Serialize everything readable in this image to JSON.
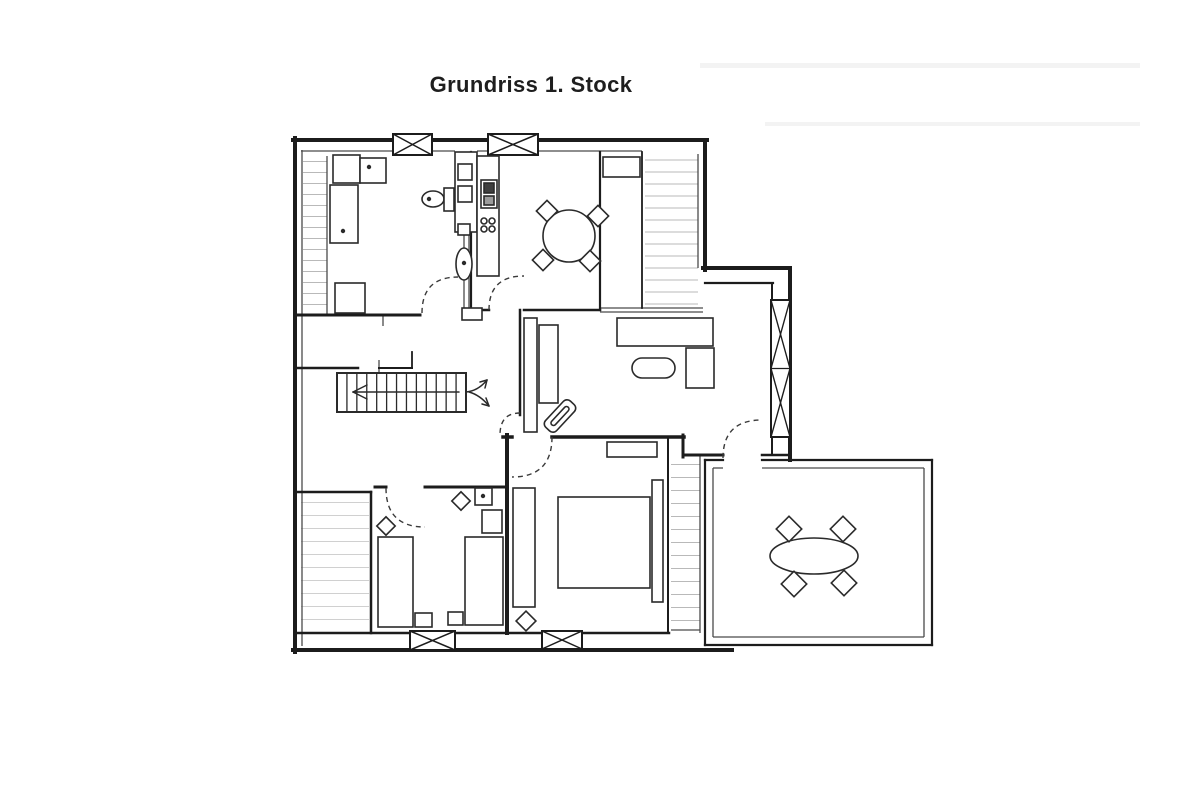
{
  "title": "Grundriss 1. Stock",
  "colors": {
    "ink": "#2a2a2a",
    "wall": "#1c1c1c",
    "thin": "#4a4a4a",
    "label": "#363636",
    "door": "#3a3a3a",
    "paper": "#ffffff",
    "hatch": "#b9b9b9",
    "hatch_light": "#d0d0d0",
    "streak": "#f3f3f3"
  },
  "rooms": [
    {
      "id": "bad",
      "label": "Bad",
      "cx": 400,
      "cy": 251,
      "size": 10
    },
    {
      "id": "kueche",
      "label": "Küche mit Essplatz",
      "cx": 562,
      "cy": 287,
      "size": 11
    },
    {
      "id": "wohnzimmer",
      "label": "Wohnzimmer",
      "cx": 647,
      "cy": 412,
      "size": 11
    },
    {
      "id": "flur",
      "label": "Flur",
      "cx": 422,
      "cy": 447,
      "size": 11.5
    },
    {
      "id": "schlafzimmer1",
      "label": "Schlafzimmer 1",
      "cx": 601,
      "cy": 480,
      "size": 11
    },
    {
      "id": "schlafzimmer2",
      "label": "Schlafzimmer 2",
      "cx": 436,
      "cy": 530,
      "size": 11
    },
    {
      "id": "dachterrasse",
      "label": "Dachterrasse",
      "cx": 804,
      "cy": 501,
      "size": 12.5
    }
  ],
  "streaks": [
    {
      "x": 700,
      "y": 63,
      "w": 440,
      "h": 5
    },
    {
      "x": 765,
      "y": 122,
      "w": 375,
      "h": 4
    }
  ],
  "walls": [
    {
      "x1": 293,
      "y1": 140,
      "x2": 707,
      "y2": 140,
      "w": 4
    },
    {
      "x1": 705,
      "y1": 140,
      "x2": 705,
      "y2": 270,
      "w": 4
    },
    {
      "x1": 703,
      "y1": 268,
      "x2": 790,
      "y2": 268,
      "w": 4
    },
    {
      "x1": 790,
      "y1": 268,
      "x2": 790,
      "y2": 460,
      "w": 4
    },
    {
      "x1": 295,
      "y1": 138,
      "x2": 295,
      "y2": 652,
      "w": 4
    },
    {
      "x1": 293,
      "y1": 650,
      "x2": 732,
      "y2": 650,
      "w": 4
    },
    {
      "x1": 705,
      "y1": 283,
      "x2": 773,
      "y2": 283,
      "w": 2.2
    },
    {
      "x1": 772,
      "y1": 283,
      "x2": 772,
      "y2": 455,
      "w": 2
    },
    {
      "x1": 683,
      "y1": 435,
      "x2": 683,
      "y2": 457,
      "w": 3
    },
    {
      "x1": 683,
      "y1": 455,
      "x2": 723,
      "y2": 455,
      "w": 3
    },
    {
      "x1": 762,
      "y1": 455,
      "x2": 790,
      "y2": 455,
      "w": 2.5
    },
    {
      "x1": 295,
      "y1": 315,
      "x2": 420,
      "y2": 315,
      "w": 3
    },
    {
      "x1": 471,
      "y1": 152,
      "x2": 471,
      "y2": 318,
      "w": 2.2
    },
    {
      "x1": 295,
      "y1": 368,
      "x2": 358,
      "y2": 368,
      "w": 2.5
    },
    {
      "x1": 379,
      "y1": 368,
      "x2": 412,
      "y2": 368,
      "w": 2
    },
    {
      "x1": 412,
      "y1": 352,
      "x2": 412,
      "y2": 368,
      "w": 1.8
    },
    {
      "x1": 471,
      "y1": 310,
      "x2": 489,
      "y2": 310,
      "w": 2.5
    },
    {
      "x1": 524,
      "y1": 310,
      "x2": 600,
      "y2": 310,
      "w": 2.5
    },
    {
      "x1": 642,
      "y1": 152,
      "x2": 642,
      "y2": 308,
      "w": 1.8
    },
    {
      "x1": 600,
      "y1": 152,
      "x2": 600,
      "y2": 310,
      "w": 2.2
    },
    {
      "x1": 520,
      "y1": 310,
      "x2": 520,
      "y2": 415,
      "w": 2.5
    },
    {
      "x1": 503,
      "y1": 437,
      "x2": 512,
      "y2": 437,
      "w": 3.5
    },
    {
      "x1": 552,
      "y1": 437,
      "x2": 684,
      "y2": 437,
      "w": 3.5
    },
    {
      "x1": 507,
      "y1": 435,
      "x2": 507,
      "y2": 633,
      "w": 4
    },
    {
      "x1": 375,
      "y1": 487,
      "x2": 386,
      "y2": 487,
      "w": 3
    },
    {
      "x1": 425,
      "y1": 487,
      "x2": 504,
      "y2": 487,
      "w": 3
    },
    {
      "x1": 295,
      "y1": 492,
      "x2": 371,
      "y2": 492,
      "w": 2.5
    },
    {
      "x1": 371,
      "y1": 492,
      "x2": 371,
      "y2": 633,
      "w": 2.5
    },
    {
      "x1": 295,
      "y1": 633,
      "x2": 410,
      "y2": 633,
      "w": 2.5
    },
    {
      "x1": 455,
      "y1": 633,
      "x2": 542,
      "y2": 633,
      "w": 2.5
    },
    {
      "x1": 583,
      "y1": 633,
      "x2": 669,
      "y2": 633,
      "w": 2.5
    },
    {
      "x1": 668,
      "y1": 437,
      "x2": 668,
      "y2": 633,
      "w": 2
    },
    {
      "x1": 705,
      "y1": 460,
      "x2": 723,
      "y2": 460,
      "w": 2.2
    },
    {
      "x1": 762,
      "y1": 460,
      "x2": 932,
      "y2": 460,
      "w": 2.2
    },
    {
      "x1": 932,
      "y1": 460,
      "x2": 932,
      "y2": 645,
      "w": 2.2
    },
    {
      "x1": 705,
      "y1": 645,
      "x2": 932,
      "y2": 645,
      "w": 2.2
    },
    {
      "x1": 705,
      "y1": 460,
      "x2": 705,
      "y2": 645,
      "w": 2.2
    }
  ],
  "thin_lines": [
    {
      "x1": 301,
      "y1": 151,
      "x2": 455,
      "y2": 151
    },
    {
      "x1": 477,
      "y1": 151,
      "x2": 642,
      "y2": 151
    },
    {
      "x1": 302,
      "y1": 150,
      "x2": 302,
      "y2": 646
    },
    {
      "x1": 327,
      "y1": 156,
      "x2": 327,
      "y2": 314
    },
    {
      "x1": 698,
      "y1": 154,
      "x2": 698,
      "y2": 268
    },
    {
      "x1": 700,
      "y1": 455,
      "x2": 700,
      "y2": 633
    },
    {
      "x1": 600,
      "y1": 308,
      "x2": 703,
      "y2": 308
    },
    {
      "x1": 600,
      "y1": 312,
      "x2": 703,
      "y2": 312
    },
    {
      "x1": 464,
      "y1": 232,
      "x2": 464,
      "y2": 308
    },
    {
      "x1": 469,
      "y1": 232,
      "x2": 469,
      "y2": 308
    },
    {
      "x1": 379,
      "y1": 360,
      "x2": 379,
      "y2": 373
    },
    {
      "x1": 383,
      "y1": 315,
      "x2": 383,
      "y2": 326
    },
    {
      "x1": 713,
      "y1": 468,
      "x2": 713,
      "y2": 637
    },
    {
      "x1": 924,
      "y1": 468,
      "x2": 924,
      "y2": 637
    },
    {
      "x1": 713,
      "y1": 637,
      "x2": 924,
      "y2": 637
    },
    {
      "x1": 713,
      "y1": 468,
      "x2": 723,
      "y2": 468
    },
    {
      "x1": 762,
      "y1": 468,
      "x2": 924,
      "y2": 468
    },
    {
      "x1": 671,
      "y1": 630,
      "x2": 700,
      "y2": 630
    }
  ],
  "hatch_areas": [
    {
      "x": 303,
      "y": 156,
      "w": 24,
      "h": 158,
      "s": 11,
      "c": "#b9b9b9"
    },
    {
      "x": 645,
      "y": 154,
      "w": 53,
      "h": 152,
      "s": 12,
      "c": "#b9b9b9"
    },
    {
      "x": 671,
      "y": 458,
      "w": 29,
      "h": 170,
      "s": 13,
      "c": "#b9b9b9"
    },
    {
      "x": 301,
      "y": 496,
      "w": 68,
      "h": 134,
      "s": 13,
      "c": "#d0d0d0"
    }
  ],
  "windows": [
    {
      "x": 393,
      "y": 134,
      "w": 39,
      "h": 21
    },
    {
      "x": 488,
      "y": 134,
      "w": 50,
      "h": 21
    },
    {
      "x": 410,
      "y": 631,
      "w": 45,
      "h": 19
    },
    {
      "x": 542,
      "y": 631,
      "w": 40,
      "h": 18
    },
    {
      "x": 771,
      "y": 300,
      "w": 19,
      "h": 137
    }
  ],
  "doors": [
    {
      "name": "bad-door",
      "d": "M 422 313 Q 422 277 458 277"
    },
    {
      "name": "kitchen-door",
      "d": "M 489 310 Q 489 276 524 276"
    },
    {
      "name": "bedroom1-door",
      "d": "M 552 437 Q 552 477 512 477"
    },
    {
      "name": "bedroom2-door",
      "d": "M 386 488 Q 386 527 425 527"
    },
    {
      "name": "terrace-door",
      "d": "M 723 458 Q 723 420 762 420"
    },
    {
      "name": "hall-passage-door",
      "d": "M 520 413 Q 500 413 500 435"
    }
  ],
  "stairs": {
    "x": 337,
    "y": 373,
    "w": 129,
    "h": 39,
    "treads": 13
  },
  "arrows": {
    "lines": [
      [
        353,
        392,
        459,
        392
      ],
      [
        353,
        392,
        367,
        385
      ],
      [
        353,
        392,
        367,
        399
      ],
      [
        487,
        380,
        480,
        382
      ],
      [
        487,
        380,
        485,
        388
      ],
      [
        489,
        406,
        482,
        404
      ],
      [
        489,
        406,
        486,
        398
      ]
    ],
    "curves": [
      "M 466 392 Q 478 391 487 380",
      "M 469 392 Q 480 395 489 406"
    ]
  },
  "furniture": [
    {
      "room": "bad",
      "items": [
        {
          "name": "bath-vanity",
          "type": "rect",
          "x": 333,
          "y": 155,
          "w": 27,
          "h": 28
        },
        {
          "name": "bath-vanity-2",
          "type": "rect",
          "x": 360,
          "y": 158,
          "w": 26,
          "h": 25,
          "dot": [
            369,
            167
          ]
        },
        {
          "name": "shower",
          "type": "rect",
          "x": 330,
          "y": 185,
          "w": 28,
          "h": 58,
          "dot": [
            343,
            231
          ]
        },
        {
          "name": "bath-cabinet",
          "type": "rect",
          "x": 335,
          "y": 283,
          "w": 30,
          "h": 30
        },
        {
          "name": "toilet",
          "type": "ellipse",
          "cx": 433,
          "cy": 199,
          "rx": 11,
          "ry": 8,
          "dot": [
            429,
            199
          ]
        },
        {
          "name": "toilet-cistern",
          "type": "rect",
          "x": 444,
          "y": 188,
          "w": 10,
          "h": 23
        },
        {
          "name": "pedestal-sink",
          "type": "ellipse",
          "cx": 464,
          "cy": 264,
          "rx": 8,
          "ry": 16,
          "dot": [
            464,
            263
          ]
        },
        {
          "name": "installation-shaft",
          "type": "rect",
          "x": 455,
          "y": 152,
          "w": 22,
          "h": 80
        },
        {
          "name": "shaft-box-1",
          "type": "rect",
          "x": 458,
          "y": 164,
          "w": 14,
          "h": 16
        },
        {
          "name": "shaft-box-2",
          "type": "rect",
          "x": 458,
          "y": 186,
          "w": 14,
          "h": 16
        },
        {
          "name": "shaft-box-3",
          "type": "rect",
          "x": 458,
          "y": 224,
          "w": 12,
          "h": 11
        },
        {
          "name": "wall-pier",
          "type": "rect",
          "x": 462,
          "y": 308,
          "w": 20,
          "h": 12
        }
      ]
    },
    {
      "room": "kueche",
      "items": [
        {
          "name": "kitchen-counter",
          "type": "rect",
          "x": 477,
          "y": 156,
          "w": 22,
          "h": 120
        },
        {
          "name": "stove",
          "type": "rect",
          "x": 481,
          "y": 180,
          "w": 16,
          "h": 28
        },
        {
          "name": "stove-detail-dark",
          "type": "rect",
          "x": 484,
          "y": 183,
          "w": 10,
          "h": 10,
          "fill": "#3f3f3f"
        },
        {
          "name": "stove-detail",
          "type": "rect",
          "x": 484,
          "y": 196,
          "w": 10,
          "h": 9,
          "fill": "#9c9c9c"
        },
        {
          "name": "burner-1",
          "type": "circle",
          "cx": 484,
          "cy": 221,
          "r": 3
        },
        {
          "name": "burner-2",
          "type": "circle",
          "cx": 492,
          "cy": 221,
          "r": 3
        },
        {
          "name": "burner-3",
          "type": "circle",
          "cx": 484,
          "cy": 229,
          "r": 3
        },
        {
          "name": "burner-4",
          "type": "circle",
          "cx": 492,
          "cy": 229,
          "r": 3
        },
        {
          "name": "dining-table",
          "type": "circle",
          "cx": 569,
          "cy": 236,
          "r": 26
        },
        {
          "name": "dining-chair-1",
          "type": "rotsq",
          "cx": 547,
          "cy": 211,
          "s": 15,
          "a": 45
        },
        {
          "name": "dining-chair-2",
          "type": "rotsq",
          "cx": 598,
          "cy": 216,
          "s": 15,
          "a": 45
        },
        {
          "name": "dining-chair-3",
          "type": "rotsq",
          "cx": 543,
          "cy": 260,
          "s": 15,
          "a": 45
        },
        {
          "name": "dining-chair-4",
          "type": "rotsq",
          "cx": 590,
          "cy": 261,
          "s": 15,
          "a": 45
        },
        {
          "name": "kitchen-sideboard",
          "type": "rect",
          "x": 603,
          "y": 157,
          "w": 37,
          "h": 20
        }
      ]
    },
    {
      "room": "wohnzimmer",
      "items": [
        {
          "name": "wall-shelf",
          "type": "rect",
          "x": 524,
          "y": 318,
          "w": 13,
          "h": 114
        },
        {
          "name": "tv-lowboard",
          "type": "rect",
          "x": 539,
          "y": 325,
          "w": 19,
          "h": 78
        },
        {
          "name": "tv",
          "type": "rrect",
          "x": 542,
          "y": 408.5,
          "w": 36,
          "h": 15,
          "rx": 5,
          "a": -47
        },
        {
          "name": "tv-screen",
          "type": "rrect",
          "x": 548,
          "y": 413.5,
          "w": 24,
          "h": 5,
          "rx": 2.5,
          "a": -47
        },
        {
          "name": "sofa",
          "type": "rect",
          "x": 617,
          "y": 318,
          "w": 96,
          "h": 28
        },
        {
          "name": "sofa-corner",
          "type": "rect",
          "x": 686,
          "y": 348,
          "w": 28,
          "h": 40
        },
        {
          "name": "coffee-table",
          "type": "rrect",
          "x": 632,
          "y": 358,
          "w": 43,
          "h": 20,
          "rx": 10,
          "a": 0
        }
      ]
    },
    {
      "room": "schlafzimmer1",
      "items": [
        {
          "name": "bedroom1-sideboard",
          "type": "rect",
          "x": 607,
          "y": 442,
          "w": 50,
          "h": 15
        },
        {
          "name": "wardrobe",
          "type": "rect",
          "x": 513,
          "y": 488,
          "w": 22,
          "h": 119
        },
        {
          "name": "double-bed",
          "type": "rect",
          "x": 558,
          "y": 497,
          "w": 92,
          "h": 91
        },
        {
          "name": "bed-headboard",
          "type": "rect",
          "x": 652,
          "y": 480,
          "w": 11,
          "h": 122
        },
        {
          "name": "bedroom1-chair",
          "type": "rotsq",
          "cx": 526,
          "cy": 621,
          "s": 14,
          "a": 45
        }
      ]
    },
    {
      "room": "schlafzimmer2",
      "items": [
        {
          "name": "single-bed-left",
          "type": "rect",
          "x": 378,
          "y": 537,
          "w": 35,
          "h": 90
        },
        {
          "name": "bed-bench-left",
          "type": "rect",
          "x": 415,
          "y": 613,
          "w": 17,
          "h": 14
        },
        {
          "name": "single-bed-right",
          "type": "rect",
          "x": 465,
          "y": 537,
          "w": 38,
          "h": 88
        },
        {
          "name": "bed-bench-right",
          "type": "rect",
          "x": 448,
          "y": 612,
          "w": 15,
          "h": 13
        },
        {
          "name": "bedroom2-chair-1",
          "type": "rotsq",
          "cx": 386,
          "cy": 526,
          "s": 13,
          "a": 45
        },
        {
          "name": "bedroom2-chair-2",
          "type": "rotsq",
          "cx": 461,
          "cy": 501,
          "s": 13,
          "a": 45
        },
        {
          "name": "corner-washbasin",
          "type": "rect",
          "x": 475,
          "y": 488,
          "w": 17,
          "h": 17,
          "dot": [
            483,
            496
          ]
        },
        {
          "name": "dresser",
          "type": "rect",
          "x": 482,
          "y": 510,
          "w": 20,
          "h": 23
        }
      ]
    },
    {
      "room": "dachterrasse",
      "items": [
        {
          "name": "terrace-table",
          "type": "ellipse",
          "cx": 814,
          "cy": 556,
          "rx": 44,
          "ry": 18
        },
        {
          "name": "terrace-chair-1",
          "type": "rotsq",
          "cx": 789,
          "cy": 529,
          "s": 18,
          "a": 45
        },
        {
          "name": "terrace-chair-2",
          "type": "rotsq",
          "cx": 843,
          "cy": 529,
          "s": 18,
          "a": 45
        },
        {
          "name": "terrace-chair-3",
          "type": "rotsq",
          "cx": 794,
          "cy": 584,
          "s": 18,
          "a": 45
        },
        {
          "name": "terrace-chair-4",
          "type": "rotsq",
          "cx": 844,
          "cy": 583,
          "s": 18,
          "a": 45
        }
      ]
    }
  ]
}
